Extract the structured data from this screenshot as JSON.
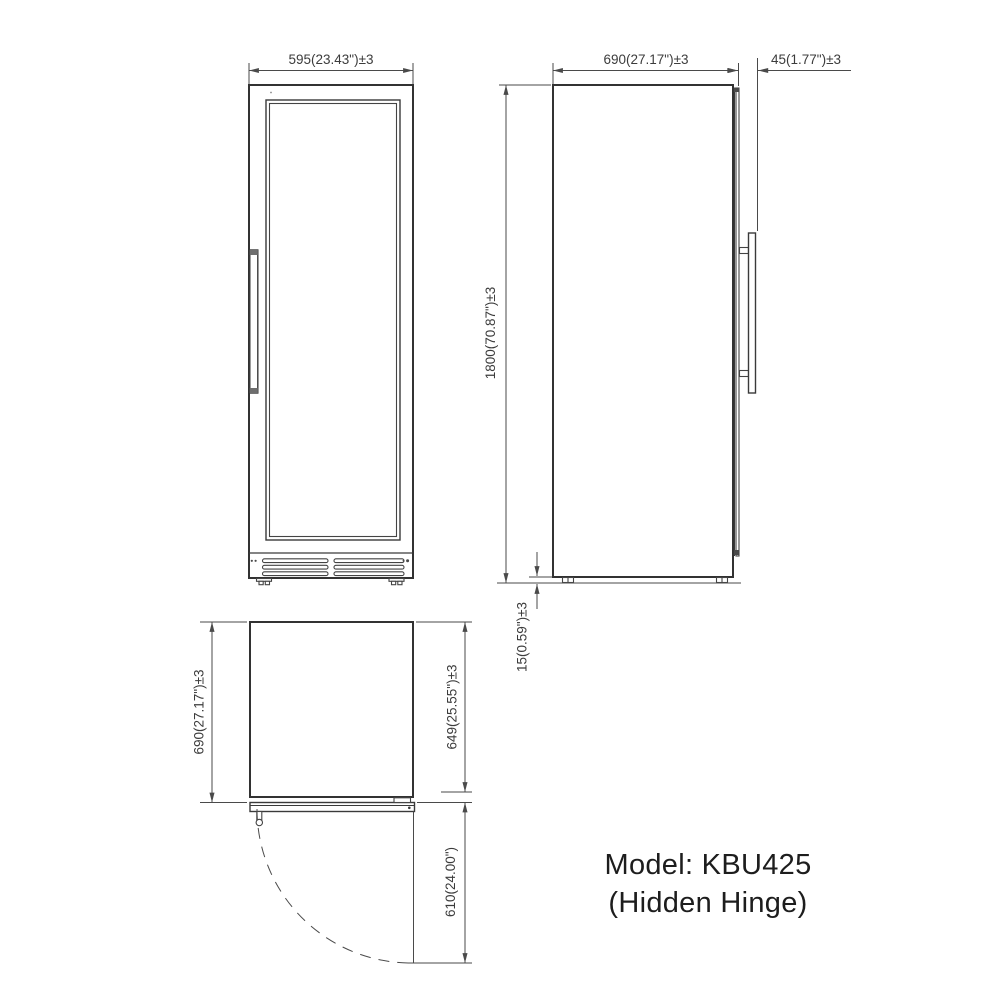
{
  "title": {
    "line1": "Model: KBU425",
    "line2": "(Hidden Hinge)"
  },
  "front_view": {
    "width_dim": "595(23.43\")±3"
  },
  "side_view": {
    "depth_dim": "690(27.17\")±3",
    "door_depth_dim": "45(1.77\")±3",
    "height_dim": "1800(70.87\")±3",
    "foot_height_dim": "15(0.59\")±3"
  },
  "top_view": {
    "depth_overall_dim": "690(27.17\")±3",
    "body_depth_dim": "649(25.55\")±3",
    "door_swing_dim": "610(24.00\")"
  },
  "colors": {
    "line": "#3a3a3a",
    "dimension": "#4a4a4a",
    "text": "#3c3c3c",
    "background": "#ffffff"
  }
}
